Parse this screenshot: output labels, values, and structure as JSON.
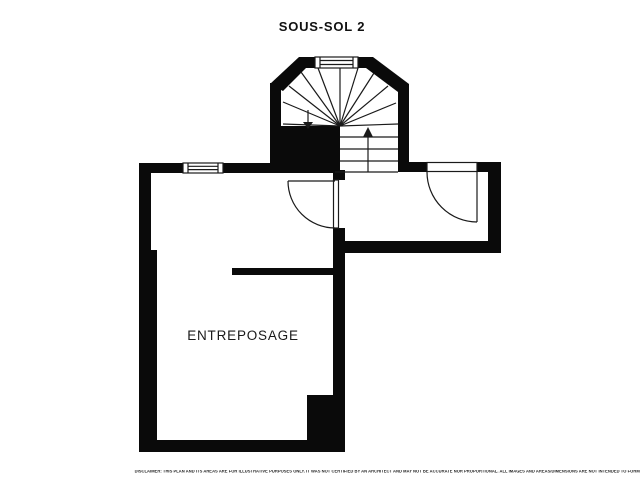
{
  "title": "SOUS-SOL 2",
  "floorplan": {
    "room_label": "ENTREPOSAGE",
    "colors": {
      "walls": "#0a0a0a",
      "background": "#ffffff",
      "lines": "#1a1a1a"
    },
    "features": {
      "stair_up_arrow": "up",
      "stair_down_arrow": "down",
      "windows": [
        "stairwell-window",
        "main-room-window"
      ],
      "doors": [
        "storage-room-door",
        "vestibule-door"
      ]
    }
  },
  "disclaimer": "DISCLAIMER: THIS PLAN AND ITS AREAS ARE FOR ILLUSTRATIVE PURPOSES ONLY. IT WAS NOT CERTIFIED BY AN ARCHITECT AND MAY NOT BE ACCURATE NOR PROPORTIONAL. ALL IMAGES AND AREAS/DIMENSIONS ARE NOT INTENDED TO FORM ANY CONTRACT OR WARRANTY."
}
